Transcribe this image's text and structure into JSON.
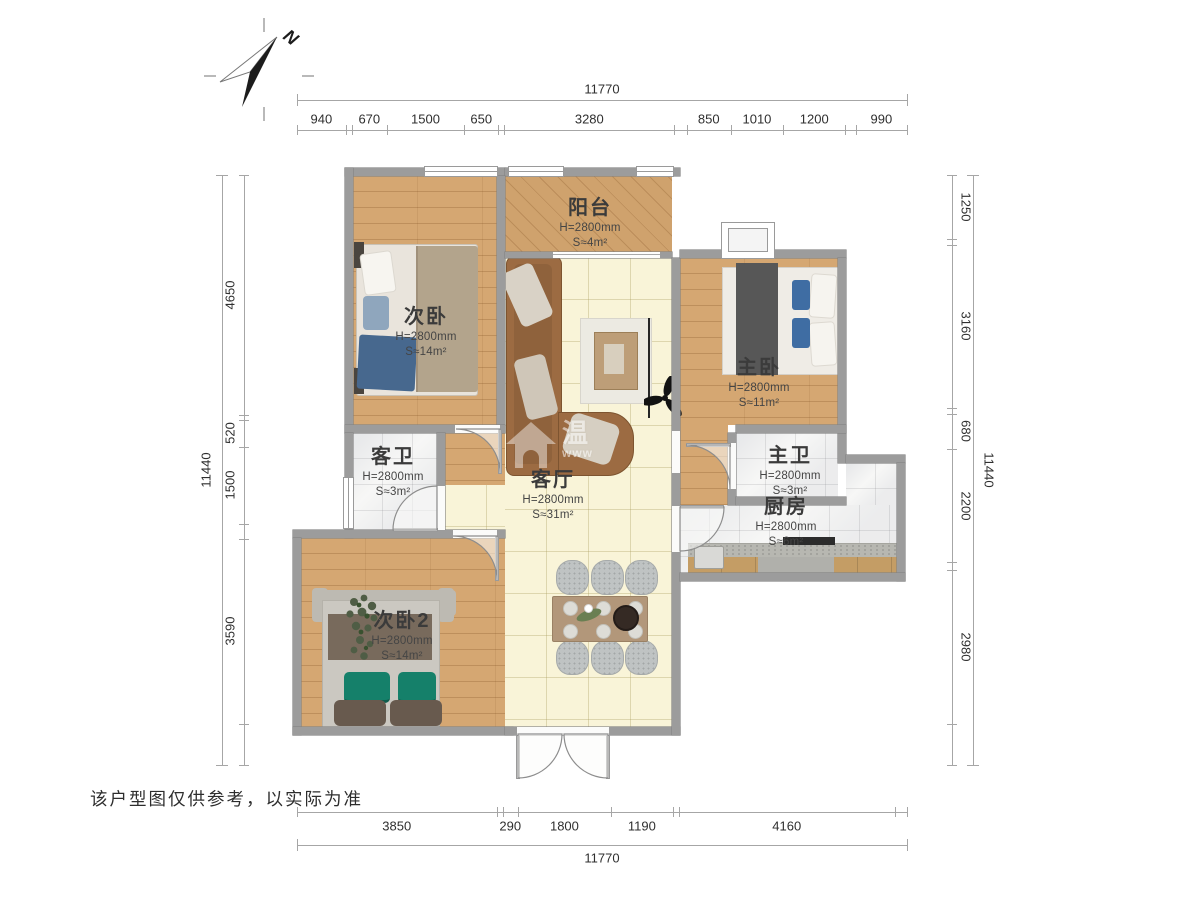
{
  "disclaimer": "该户型图仅供参考，以实际为准",
  "compass": {
    "north_label": "N"
  },
  "watermark": {
    "icon": "house-icon",
    "text": "温",
    "subtext": "www"
  },
  "rooms": [
    {
      "name": "阳台",
      "height": "H=2800mm",
      "area": "S≈4m²"
    },
    {
      "name": "次卧",
      "height": "H=2800mm",
      "area": "S≈14m²"
    },
    {
      "name": "主卧",
      "height": "H=2800mm",
      "area": "S≈11m²"
    },
    {
      "name": "客卫",
      "height": "H=2800mm",
      "area": "S≈3m²"
    },
    {
      "name": "客厅",
      "height": "H=2800mm",
      "area": "S≈31m²"
    },
    {
      "name": "主卫",
      "height": "H=2800mm",
      "area": "S≈3m²"
    },
    {
      "name": "厨房",
      "height": "H=2800mm",
      "area": "S≈6m²"
    },
    {
      "name": "次卧2",
      "height": "H=2800mm",
      "area": "S≈14m²"
    }
  ],
  "dimensions": {
    "top": {
      "total": "11770",
      "segments": [
        {
          "mm": 940,
          "label": "940"
        },
        {
          "mm": 120
        },
        {
          "mm": 670,
          "label": "670"
        },
        {
          "mm": 1500,
          "label": "1500"
        },
        {
          "mm": 650,
          "label": "650"
        },
        {
          "mm": 120
        },
        {
          "mm": 3280,
          "label": "3280"
        },
        {
          "mm": 240
        },
        {
          "mm": 850,
          "label": "850"
        },
        {
          "mm": 1010,
          "label": "1010"
        },
        {
          "mm": 1200,
          "label": "1200"
        },
        {
          "mm": 200
        },
        {
          "mm": 990,
          "label": "990"
        }
      ]
    },
    "bottom": {
      "total": "11770",
      "segments": [
        {
          "mm": 3850,
          "label": "3850"
        },
        {
          "mm": 120
        },
        {
          "mm": 290,
          "label": "290"
        },
        {
          "mm": 1800,
          "label": "1800"
        },
        {
          "mm": 1190,
          "label": "1190"
        },
        {
          "mm": 120
        },
        {
          "mm": 4160,
          "label": "4160"
        },
        {
          "mm": 240
        }
      ]
    },
    "left": {
      "total": "11440",
      "segments": [
        {
          "mm": 4650,
          "label": "4650"
        },
        {
          "mm": 100
        },
        {
          "mm": 520,
          "label": "520"
        },
        {
          "mm": 1500,
          "label": "1500"
        },
        {
          "mm": 280
        },
        {
          "mm": 3590,
          "label": "3590"
        },
        {
          "mm": 800
        }
      ]
    },
    "right": {
      "total": "11440",
      "segments": [
        {
          "mm": 1250,
          "label": "1250"
        },
        {
          "mm": 100
        },
        {
          "mm": 3160,
          "label": "3160"
        },
        {
          "mm": 120
        },
        {
          "mm": 680,
          "label": "680"
        },
        {
          "mm": 2200,
          "label": "2200"
        },
        {
          "mm": 150
        },
        {
          "mm": 2980,
          "label": "2980"
        },
        {
          "mm": 800
        }
      ]
    }
  },
  "colors": {
    "wall": "#9c9c9c",
    "wood": "#d5a772",
    "cream": "#f9f4d8",
    "tile": "#f7f7f6",
    "sofa": "#9c6b42",
    "blue": "#3f6da3",
    "green": "#15806a"
  }
}
